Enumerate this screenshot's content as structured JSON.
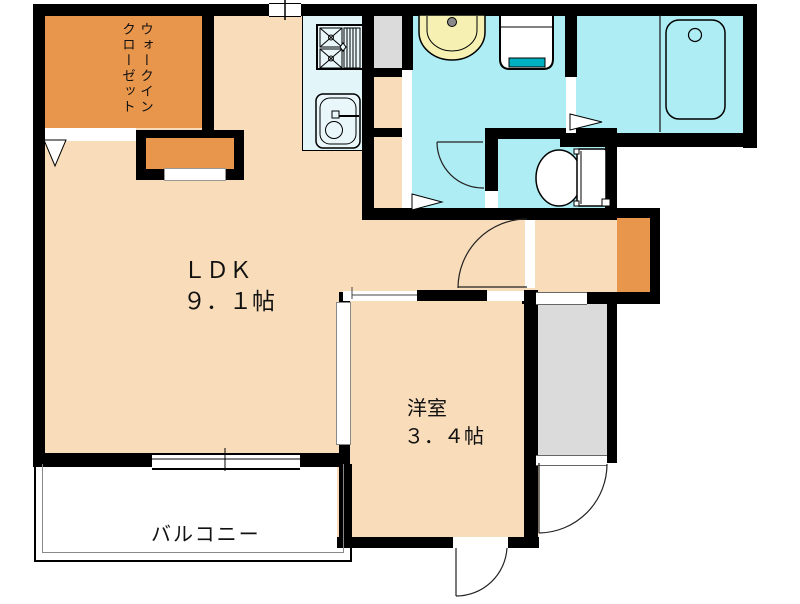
{
  "plan": {
    "type": "floor-plan",
    "labels": {
      "walk_in_closet_line1": "ウォークイン",
      "walk_in_closet_line2": "クローゼット",
      "ldk_name": "ＬＤＫ",
      "ldk_size": "９．１帖",
      "western_room_name": "洋室",
      "western_room_size": "３．４帖",
      "balcony": "バルコニー"
    },
    "rooms": [
      {
        "id": "walk-in-closet",
        "name": "ウォークインクローゼット"
      },
      {
        "id": "ldk",
        "name": "ＬＤＫ",
        "size": "９．１帖"
      },
      {
        "id": "western-room",
        "name": "洋室",
        "size": "３．４帖"
      },
      {
        "id": "balcony",
        "name": "バルコニー"
      },
      {
        "id": "kitchen",
        "name": ""
      },
      {
        "id": "washroom",
        "name": ""
      },
      {
        "id": "bathroom",
        "name": ""
      },
      {
        "id": "toilet",
        "name": ""
      },
      {
        "id": "entrance",
        "name": ""
      }
    ],
    "fixtures": [
      "stove-icon",
      "kitchen-sink-icon",
      "refrigerator-space",
      "wash-basin-icon",
      "washing-machine-icon",
      "bathtub-icon",
      "toilet-icon",
      "storage-closet",
      "shoe-cabinet"
    ],
    "colors": {
      "wall": "#000000",
      "room_peach": "#F9DCBA",
      "closet_orange": "#E9964D",
      "wet_area_cyan": "#AEEDF3",
      "counter_pale_cyan": "#E2F5F9",
      "entrance_gray": "#DBDBDB",
      "basin_cream": "#F6F1B3",
      "washer_teal": "#00AFC0"
    }
  }
}
